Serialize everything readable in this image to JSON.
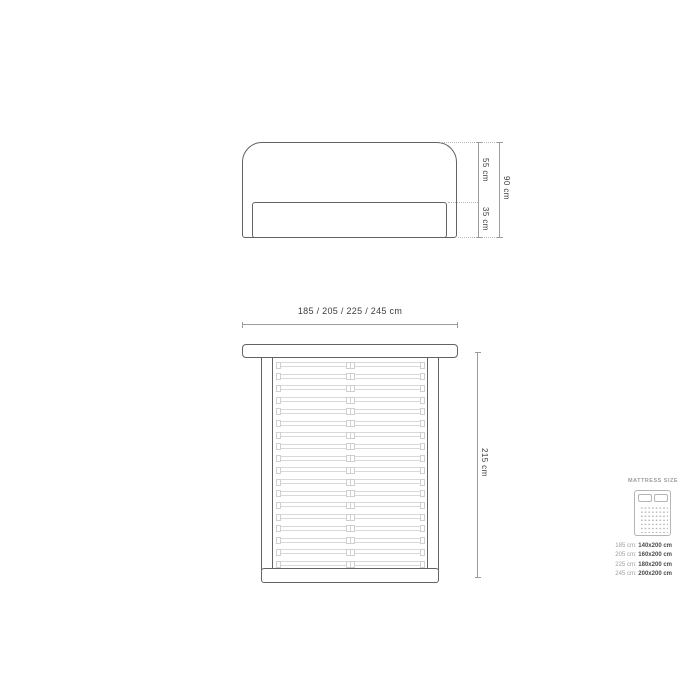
{
  "front_view": {
    "dim_upper": "55 cm",
    "dim_lower": "35 cm",
    "dim_total": "90 cm"
  },
  "plan_view": {
    "width_label": "185 / 205 / 225 / 245 cm",
    "length_label": "215 cm",
    "slat_count": 18
  },
  "legend": {
    "title": "MATTRESS SIZE",
    "rows": [
      {
        "label": "185 cm:",
        "value": "140x200 cm"
      },
      {
        "label": "205 cm:",
        "value": "160x200 cm"
      },
      {
        "label": "225 cm:",
        "value": "180x200 cm"
      },
      {
        "label": "245 cm:",
        "value": "200x200 cm"
      }
    ]
  },
  "colors": {
    "background": "#ffffff",
    "outline": "#636363",
    "dimension_line": "#9c9c9c",
    "dotted_line": "#b8b8b8",
    "slat_line": "#d9d9d9",
    "text_dark": "#3d3d3d",
    "legend_muted": "#9e9e9e",
    "legend_value": "#4a4a4a",
    "icon_line": "#b5b5b5"
  }
}
